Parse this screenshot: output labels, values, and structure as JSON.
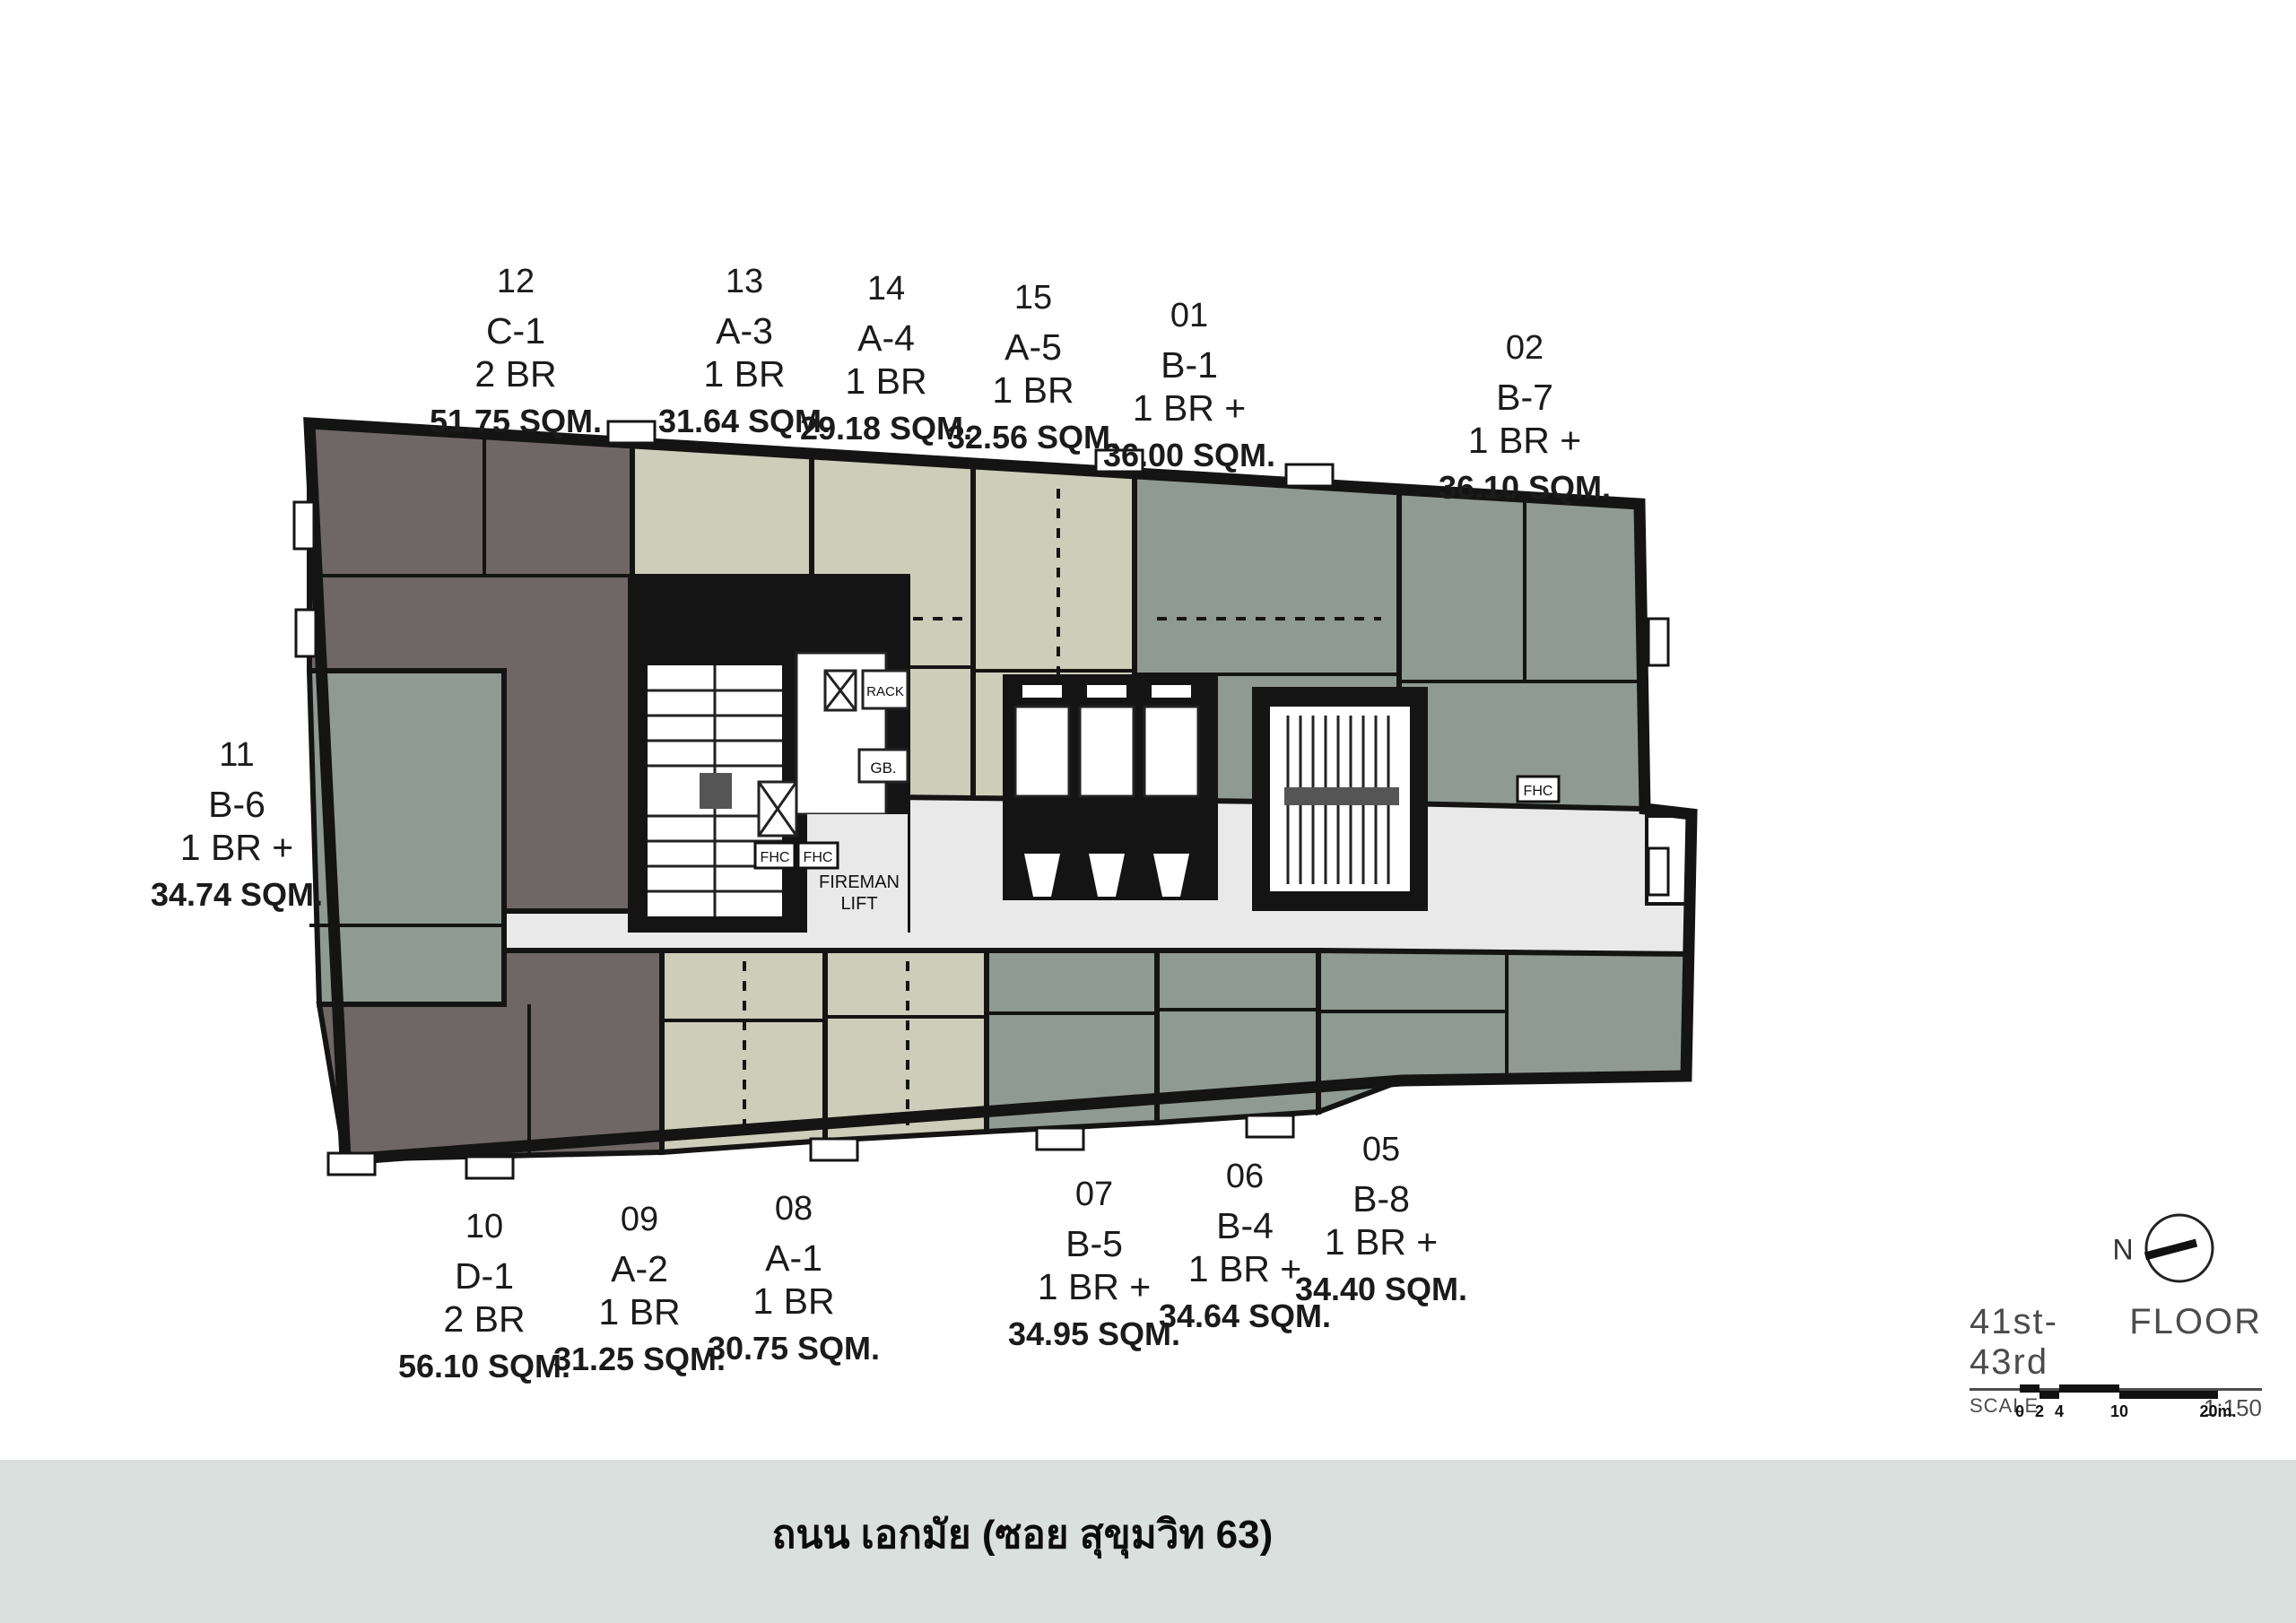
{
  "colors": {
    "wall": "#141414",
    "dark": "#6f6765",
    "green": "#8f9a92",
    "beige": "#cecdb9",
    "corridor": "#e9e9e9",
    "white": "#ffffff",
    "bar_bg": "#d9e0de"
  },
  "units": [
    {
      "number": "12",
      "name": "C-1",
      "type": "2 BR",
      "area": "51.75 SQM.",
      "color": "dark",
      "label_x": 575,
      "label_y": 292
    },
    {
      "number": "13",
      "name": "A-3",
      "type": "1 BR",
      "area": "31.64 SQM.",
      "color": "beige",
      "label_x": 830,
      "label_y": 292
    },
    {
      "number": "14",
      "name": "A-4",
      "type": "1 BR",
      "area": "29.18 SQM.",
      "color": "beige",
      "label_x": 988,
      "label_y": 300
    },
    {
      "number": "15",
      "name": "A-5",
      "type": "1 BR",
      "area": "32.56 SQM.",
      "color": "beige",
      "label_x": 1152,
      "label_y": 310
    },
    {
      "number": "01",
      "name": "B-1",
      "type": "1 BR +",
      "area": "36.00 SQM.",
      "color": "green",
      "label_x": 1326,
      "label_y": 330
    },
    {
      "number": "02",
      "name": "B-7",
      "type": "1 BR +",
      "area": "36.10 SQM.",
      "color": "green",
      "label_x": 1700,
      "label_y": 366
    },
    {
      "number": "11",
      "name": "B-6",
      "type": "1 BR +",
      "area": "34.74 SQM.",
      "color": "green",
      "label_x": 264,
      "label_y": 820
    },
    {
      "number": "10",
      "name": "D-1",
      "type": "2 BR",
      "area": "56.10 SQM.",
      "color": "dark",
      "label_x": 540,
      "label_y": 1346
    },
    {
      "number": "09",
      "name": "A-2",
      "type": "1 BR",
      "area": "31.25 SQM.",
      "color": "beige",
      "label_x": 713,
      "label_y": 1338
    },
    {
      "number": "08",
      "name": "A-1",
      "type": "1 BR",
      "area": "30.75 SQM.",
      "color": "beige",
      "label_x": 885,
      "label_y": 1326
    },
    {
      "number": "07",
      "name": "B-5",
      "type": "1 BR +",
      "area": "34.95 SQM.",
      "color": "green",
      "label_x": 1220,
      "label_y": 1310
    },
    {
      "number": "06",
      "name": "B-4",
      "type": "1 BR +",
      "area": "34.64 SQM.",
      "color": "green",
      "label_x": 1388,
      "label_y": 1290
    },
    {
      "number": "05",
      "name": "B-8",
      "type": "1 BR +",
      "area": "34.40 SQM.",
      "color": "green",
      "label_x": 1540,
      "label_y": 1260
    }
  ],
  "core_labels": {
    "fireman_line1": "FIREMAN",
    "fireman_line2": "LIFT",
    "fhc": "FHC",
    "gb": "GB.",
    "rack": "RACK"
  },
  "title_block": {
    "floor_range": "41st-43rd",
    "floor_word": "FLOOR",
    "scale_label": "SCALE",
    "scale_value": "1:150",
    "north_label": "N",
    "scale_ticks": [
      "0",
      "2",
      "4",
      "10",
      "20m."
    ]
  },
  "street_bar": {
    "label": "ถนน เอกมัย (ซอย สุขุมวิท 63)"
  }
}
